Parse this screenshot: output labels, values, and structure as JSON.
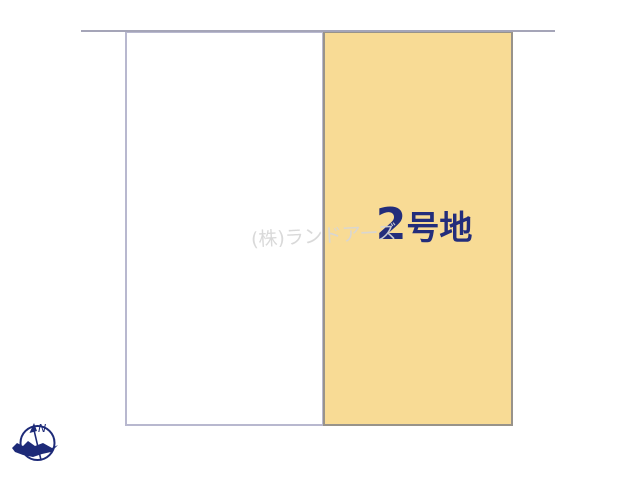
{
  "diagram": {
    "road_line_color": "#a5a5b8",
    "lot1": {
      "fill": "#ffffff",
      "border_color": "#b8b8cf"
    },
    "lot2": {
      "fill": "#f8db95",
      "border_color": "#98938a",
      "label_number": "2",
      "label_suffix": "号地",
      "label_color": "#232d7b"
    },
    "watermark": {
      "text": "(株)ランドアーズ",
      "color": "#d6d6d6"
    },
    "compass": {
      "letter": "N",
      "color": "#1d2a78"
    }
  }
}
